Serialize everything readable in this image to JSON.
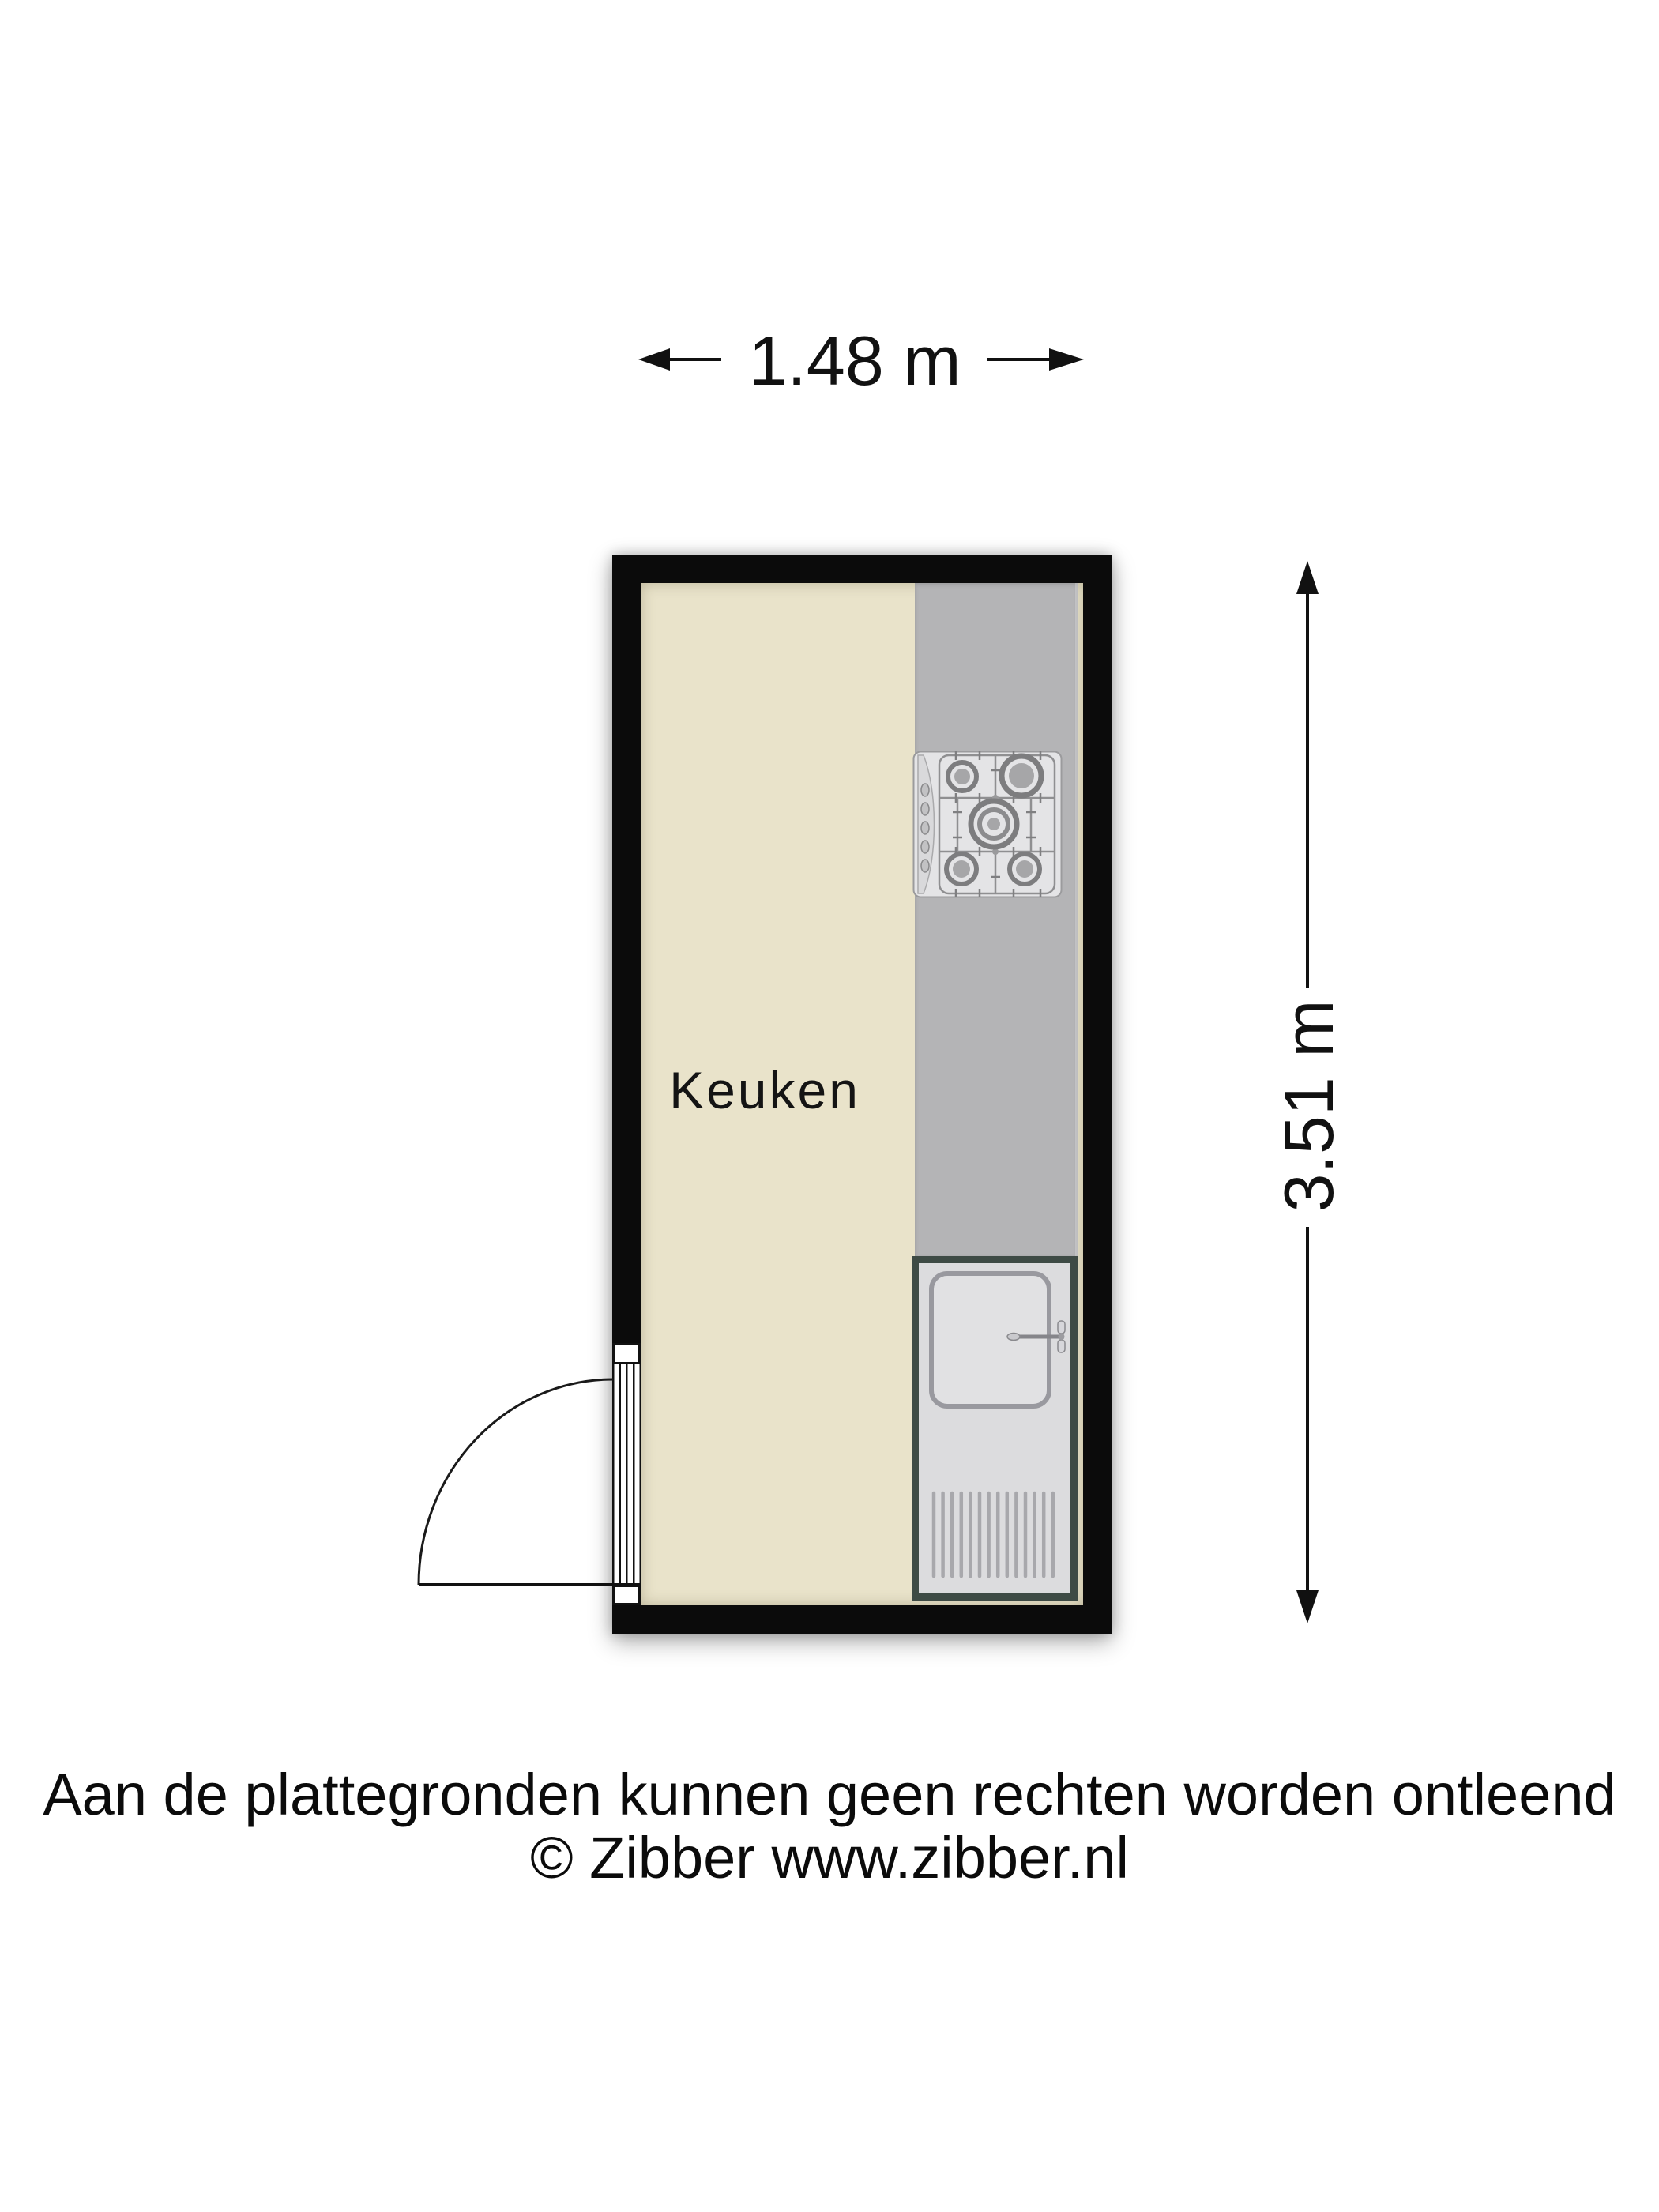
{
  "floor_plan": {
    "room": {
      "label": "Keuken"
    },
    "dimensions": {
      "width_label": "1.48 m",
      "height_label": "3.51 m"
    },
    "fixtures": {
      "stove": "gas-cooktop-5-burners",
      "sink": "sink-unit-with-faucet-and-drainboard",
      "door": "hinged-door-swing-bottom-left"
    },
    "colors": {
      "wall": "#0b0b0b",
      "floor": "#e9e3ca",
      "counter": "#b4b4b6",
      "sink_unit_border": "#3e4b45",
      "annotation_text": "#111111"
    }
  },
  "footer": {
    "disclaimer": "Aan de plattegronden kunnen geen rechten worden ontleend",
    "copyright": "© Zibber www.zibber.nl"
  }
}
